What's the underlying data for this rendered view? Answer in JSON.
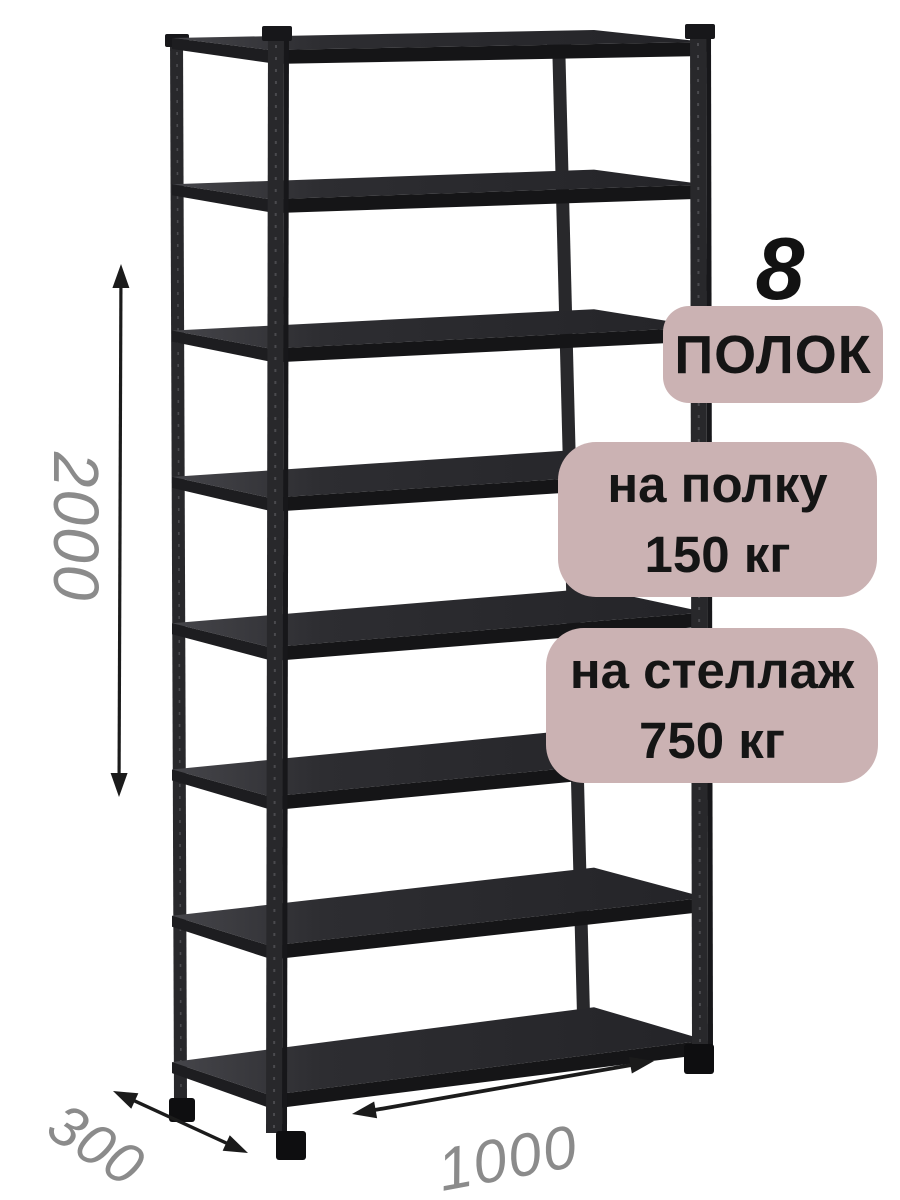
{
  "product_labels": {
    "count_number": "8",
    "count_word": "ПОЛОК",
    "per_shelf": {
      "line1": "на полку",
      "line2": "150 кг"
    },
    "per_rack": {
      "line1": "на стеллаж",
      "line2": "750 кг"
    }
  },
  "dimensions": {
    "height_mm": "2000",
    "depth_mm": "300",
    "width_mm": "1000"
  },
  "style": {
    "badge_bg": "#cbb2b3",
    "badge_text": "#151515",
    "number_color": "#121212",
    "dim_label_color": "#8b8b8b",
    "arrow_color": "#1b1b1b"
  },
  "rack": {
    "shelf_count": 8,
    "colors": {
      "top_light": "#45454a",
      "top_mid": "#2d2d31",
      "top_dark": "#242428",
      "front_edge": "#151517",
      "side_edge": "#1d1d20",
      "post": "#28282b",
      "post_dark": "#17171a",
      "foot": "#0e0e10",
      "perforation": "#4a4a4e"
    }
  }
}
